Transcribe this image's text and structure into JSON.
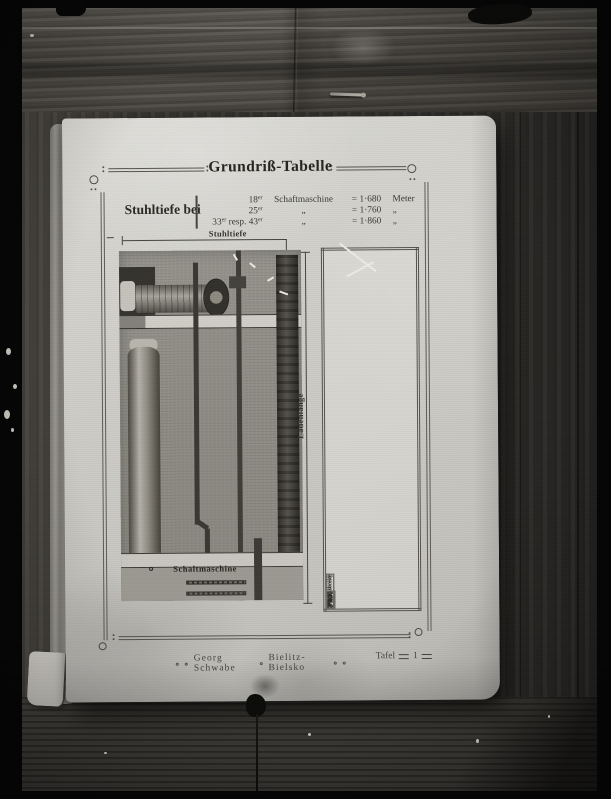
{
  "page": {
    "title": "Grundriß-Tabelle",
    "stuhltiefe": {
      "label": "Stuhltiefe bei",
      "entries": [
        {
          "n1": "18",
          "s1": "er",
          "n2": "",
          "s2": "",
          "name": "Schaftmaschine",
          "eq": "=",
          "val": "1·680",
          "unit": "Meter"
        },
        {
          "n1": "25",
          "s1": "er",
          "n2": "",
          "s2": "",
          "name": "„",
          "eq": "=",
          "val": "1·760",
          "unit": "„"
        },
        {
          "n1": "33",
          "s1": "er",
          "n2": " resp. 43",
          "s2": "er",
          "name": "„",
          "eq": "=",
          "val": "1·860",
          "unit": "„"
        }
      ]
    },
    "diagram": {
      "dim_depth": "Stuhltiefe",
      "dim_length": "Ladenlänge",
      "machine": "Schaltmaschine"
    },
    "table": {
      "header": {
        "arbeitsbreite": "Arbeitsbreite",
        "saechs_l1": "¼e",
        "saechs_l2": "sächs.",
        "meter": "Meter",
        "blatt_l1": "Blatt-",
        "blatt_l2": "breite",
        "laden_l1": "Laden-",
        "laden_l2": "länge"
      },
      "groups": [
        {
          "saechs": [
            "⁷⁄₄",
            "⁸⁄₄",
            "⁹⁄₄",
            "¹⁰⁄₄",
            "¹¹⁄₄",
            "¹²⁄₄"
          ],
          "meter": [
            "1·020",
            "1·150",
            "1·290",
            "1·430",
            "1·570",
            "1·730"
          ],
          "blatt": [
            "1·150",
            "1·280",
            "1·420",
            "1·560",
            "1·700",
            "1·860"
          ],
          "laden": [
            "2·650",
            "2·780",
            "2·920",
            "3·060",
            "3·200",
            "3·360"
          ]
        },
        {
          "saechs": [
            "¹³⁄₄",
            "¹⁴⁄₄",
            "¹⁵⁄₄",
            "¹⁶⁄₄",
            "¹⁷⁄₄",
            "¹⁸⁄₄"
          ],
          "meter": [
            "1·810",
            "1·930",
            "2·020",
            "2·170",
            "2·370",
            "2·510"
          ],
          "blatt": [
            "1·940",
            "2·060",
            "2·150",
            "2·300",
            "2·500",
            "2·640"
          ],
          "laden": [
            "3·440",
            "3·560",
            "3·650",
            "3·800",
            "4·000",
            "4·140"
          ]
        },
        {
          "saechs": [
            "¹⁹⁄₄",
            "²⁰⁄₄",
            "²¹⁄₄",
            "²²⁄₄",
            "²³⁄₄",
            "²⁴⁄₄"
          ],
          "meter": [
            "2·670",
            "2·870",
            "3·020",
            "3·140",
            "3·250",
            "3·370"
          ],
          "blatt": [
            "2·800",
            "3·000",
            "3·150",
            "3·270",
            "3·380",
            "3·500"
          ],
          "laden": [
            "4·300",
            "4·500",
            "4·650",
            "4·770",
            "4·880",
            "5·000"
          ]
        }
      ]
    },
    "footer": {
      "publisher": "Georg Schwabe",
      "city": "Bielitz-Bielsko",
      "plate_word": "Tafel",
      "plate_number": "1"
    }
  }
}
